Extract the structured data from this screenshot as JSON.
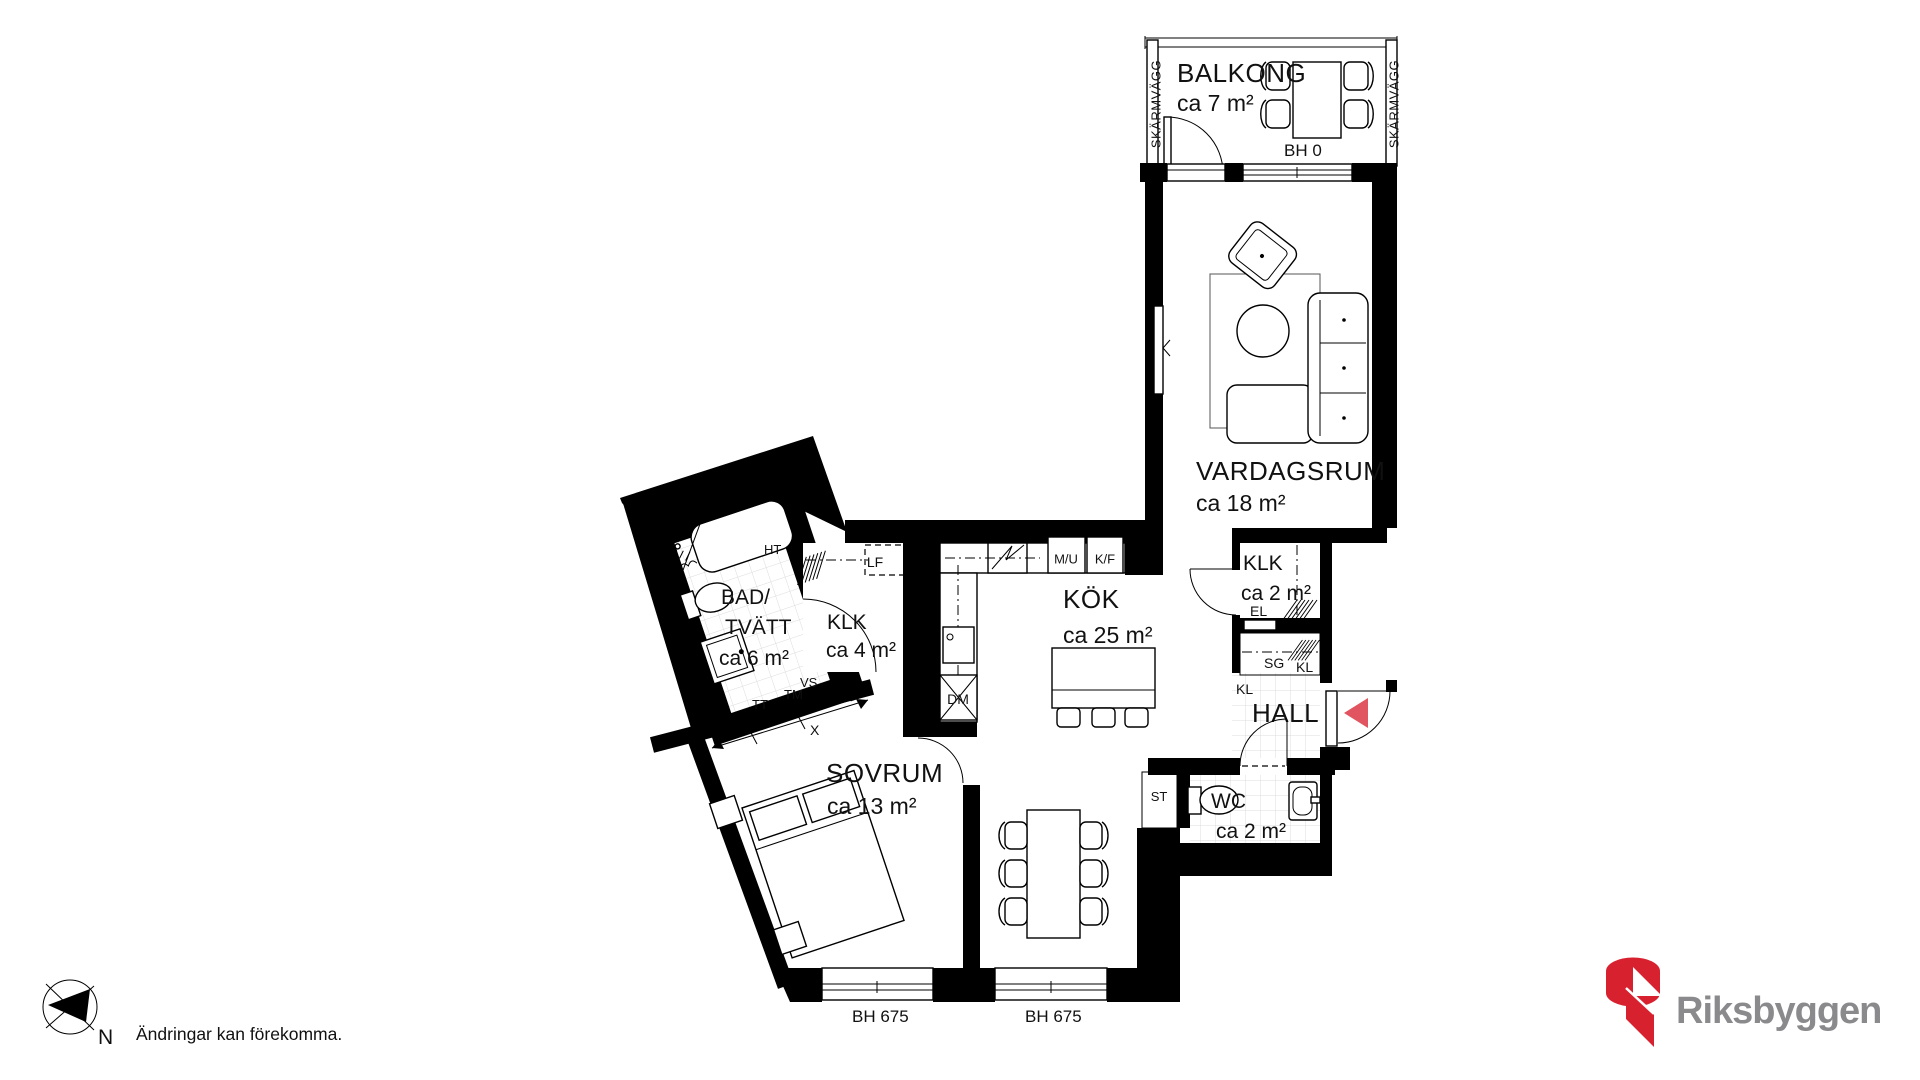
{
  "floorplan": {
    "rooms": [
      {
        "id": "balkong",
        "name": "BALKONG",
        "area": "ca 7 m²"
      },
      {
        "id": "vardagsrum",
        "name": "VARDAGSRUM",
        "area": "ca 18 m²"
      },
      {
        "id": "kok",
        "name": "KÖK",
        "area": "ca 25 m²"
      },
      {
        "id": "sovrum",
        "name": "SOVRUM",
        "area": "ca 13 m²"
      },
      {
        "id": "bad-tvatt",
        "name": "BAD/",
        "name2": "TVÄTT",
        "area": "ca 6 m²"
      },
      {
        "id": "klk-stor",
        "name": "KLK",
        "area": "ca 4 m²"
      },
      {
        "id": "klk-liten",
        "name": "KLK",
        "area": "ca 2 m²"
      },
      {
        "id": "hall",
        "name": "HALL"
      },
      {
        "id": "wc",
        "name": "WC",
        "area": "ca 2 m²"
      }
    ],
    "fixtures": {
      "mu": "M/U",
      "kf": "K/F",
      "dm": "DM",
      "lf": "LF",
      "ht": "HT",
      "vs": "VS",
      "tm": "TM",
      "tt": "TT",
      "dim_x": "X",
      "el": "EL",
      "sg": "SG",
      "kl_a": "KL",
      "kl_b": "KL",
      "st": "ST"
    },
    "windows": {
      "bh_sovrum": "BH 675",
      "bh_kok": "BH 675",
      "bh_balkong": "BH 0"
    },
    "balcony": {
      "screen_left": "SKÄRMVÄGG",
      "screen_right": "SKÄRMVÄGG"
    }
  },
  "footer": {
    "compass": "N",
    "disclaimer": "Ändringar kan förekomma."
  },
  "brand": {
    "name": "Riksbyggen",
    "red": "#d7212f",
    "gray": "#8a8a8d"
  },
  "colors": {
    "entry_arrow": "#e05560",
    "wall": "#000000",
    "tile_line": "#dcdcdc"
  }
}
